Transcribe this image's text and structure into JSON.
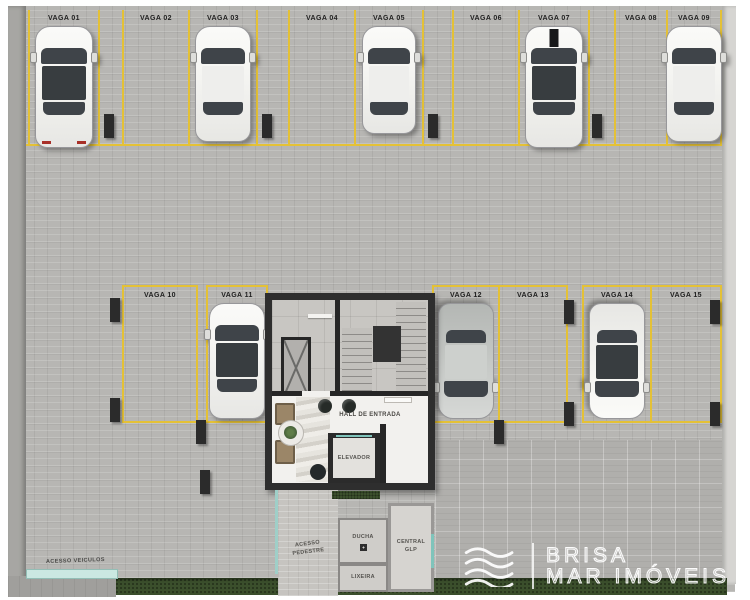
{
  "palette": {
    "yellow_line": "#e4c136",
    "wall_dark": "#2e2e2e",
    "glass": "#3f4449",
    "grass": "#3b4f2c",
    "teal": "#9fcfc8",
    "floor": "#b7b6b3",
    "hall_floor": "#f2f1ee",
    "concrete": "#c8c6c2",
    "car_white": "#f5f5f2",
    "car_silver": "#c7cac7"
  },
  "stalls": [
    {
      "label": "VAGA 01",
      "occupied": true,
      "car": {
        "body": "white",
        "roof": "dark",
        "type": "suv"
      }
    },
    {
      "label": "VAGA 02",
      "occupied": false
    },
    {
      "label": "VAGA 03",
      "occupied": true,
      "car": {
        "body": "white",
        "roof": "light",
        "type": "sedan"
      }
    },
    {
      "label": "VAGA 04",
      "occupied": false
    },
    {
      "label": "VAGA 05",
      "occupied": true,
      "car": {
        "body": "white",
        "roof": "light",
        "type": "hatch"
      }
    },
    {
      "label": "VAGA 06",
      "occupied": false
    },
    {
      "label": "VAGA 07",
      "occupied": true,
      "car": {
        "body": "white",
        "roof": "dark",
        "type": "suv-stripe"
      }
    },
    {
      "label": "VAGA 08",
      "occupied": false
    },
    {
      "label": "VAGA 09",
      "occupied": true,
      "car": {
        "body": "white",
        "roof": "light",
        "type": "sedan"
      }
    },
    {
      "label": "VAGA 10",
      "occupied": false
    },
    {
      "label": "VAGA 11",
      "occupied": true,
      "car": {
        "body": "white",
        "roof": "dark",
        "type": "sedan"
      }
    },
    {
      "label": "VAGA 12",
      "occupied": true,
      "car": {
        "body": "silver",
        "roof": "light",
        "type": "sedan",
        "facing": "down"
      }
    },
    {
      "label": "VAGA 13",
      "occupied": false
    },
    {
      "label": "VAGA 14",
      "occupied": true,
      "car": {
        "body": "white",
        "roof": "dark",
        "type": "sedan",
        "facing": "down"
      }
    },
    {
      "label": "VAGA 15",
      "occupied": false
    }
  ],
  "core": {
    "hall_label": "HALL DE ENTRADA",
    "elevator_label": "ELEVADOR"
  },
  "rooms": {
    "ducha": "DUCHA",
    "lixeira": "LIXEIRA",
    "central_glp": "CENTRAL GLP"
  },
  "access": {
    "pedestrian": "ACESSO PEDESTRE",
    "vehicles": "ACESSO VEICULOS"
  },
  "logo": {
    "line1": "BRISA",
    "line2": "MAR IMÓVEIS"
  }
}
